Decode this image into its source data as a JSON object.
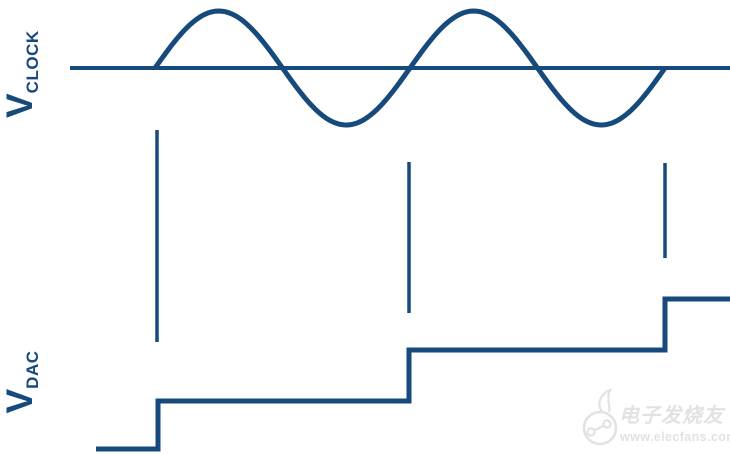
{
  "colors": {
    "background": "#ffffff",
    "line": "#174a7c",
    "watermark": "#e2e2e2"
  },
  "labels": {
    "clock_main": "V",
    "clock_sub": "CLOCK",
    "dac_main": "V",
    "dac_sub": "DAC"
  },
  "watermark": {
    "brand_cjk": "电子发烧友",
    "brand_url": "www.elecfans.com"
  },
  "diagram": {
    "clock": {
      "baseline": {
        "x1": 70,
        "x2": 730,
        "y": 68
      },
      "sine": {
        "x_start": 155,
        "x_end": 665,
        "center_y": 68,
        "amplitude": 57,
        "period": 255,
        "cycles": 2
      }
    },
    "sample_lines": [
      {
        "x": 157,
        "y1": 130,
        "y2": 342
      },
      {
        "x": 409,
        "y1": 162,
        "y2": 313
      },
      {
        "x": 665,
        "y1": 163,
        "y2": 258
      }
    ],
    "dac_staircase": {
      "levels": [
        {
          "y": 449,
          "x1": 96,
          "x2": 158
        },
        {
          "y": 401,
          "x1": 158,
          "x2": 409
        },
        {
          "y": 350,
          "x1": 409,
          "x2": 665
        },
        {
          "y": 299,
          "x1": 665,
          "x2": 730
        }
      ]
    }
  }
}
